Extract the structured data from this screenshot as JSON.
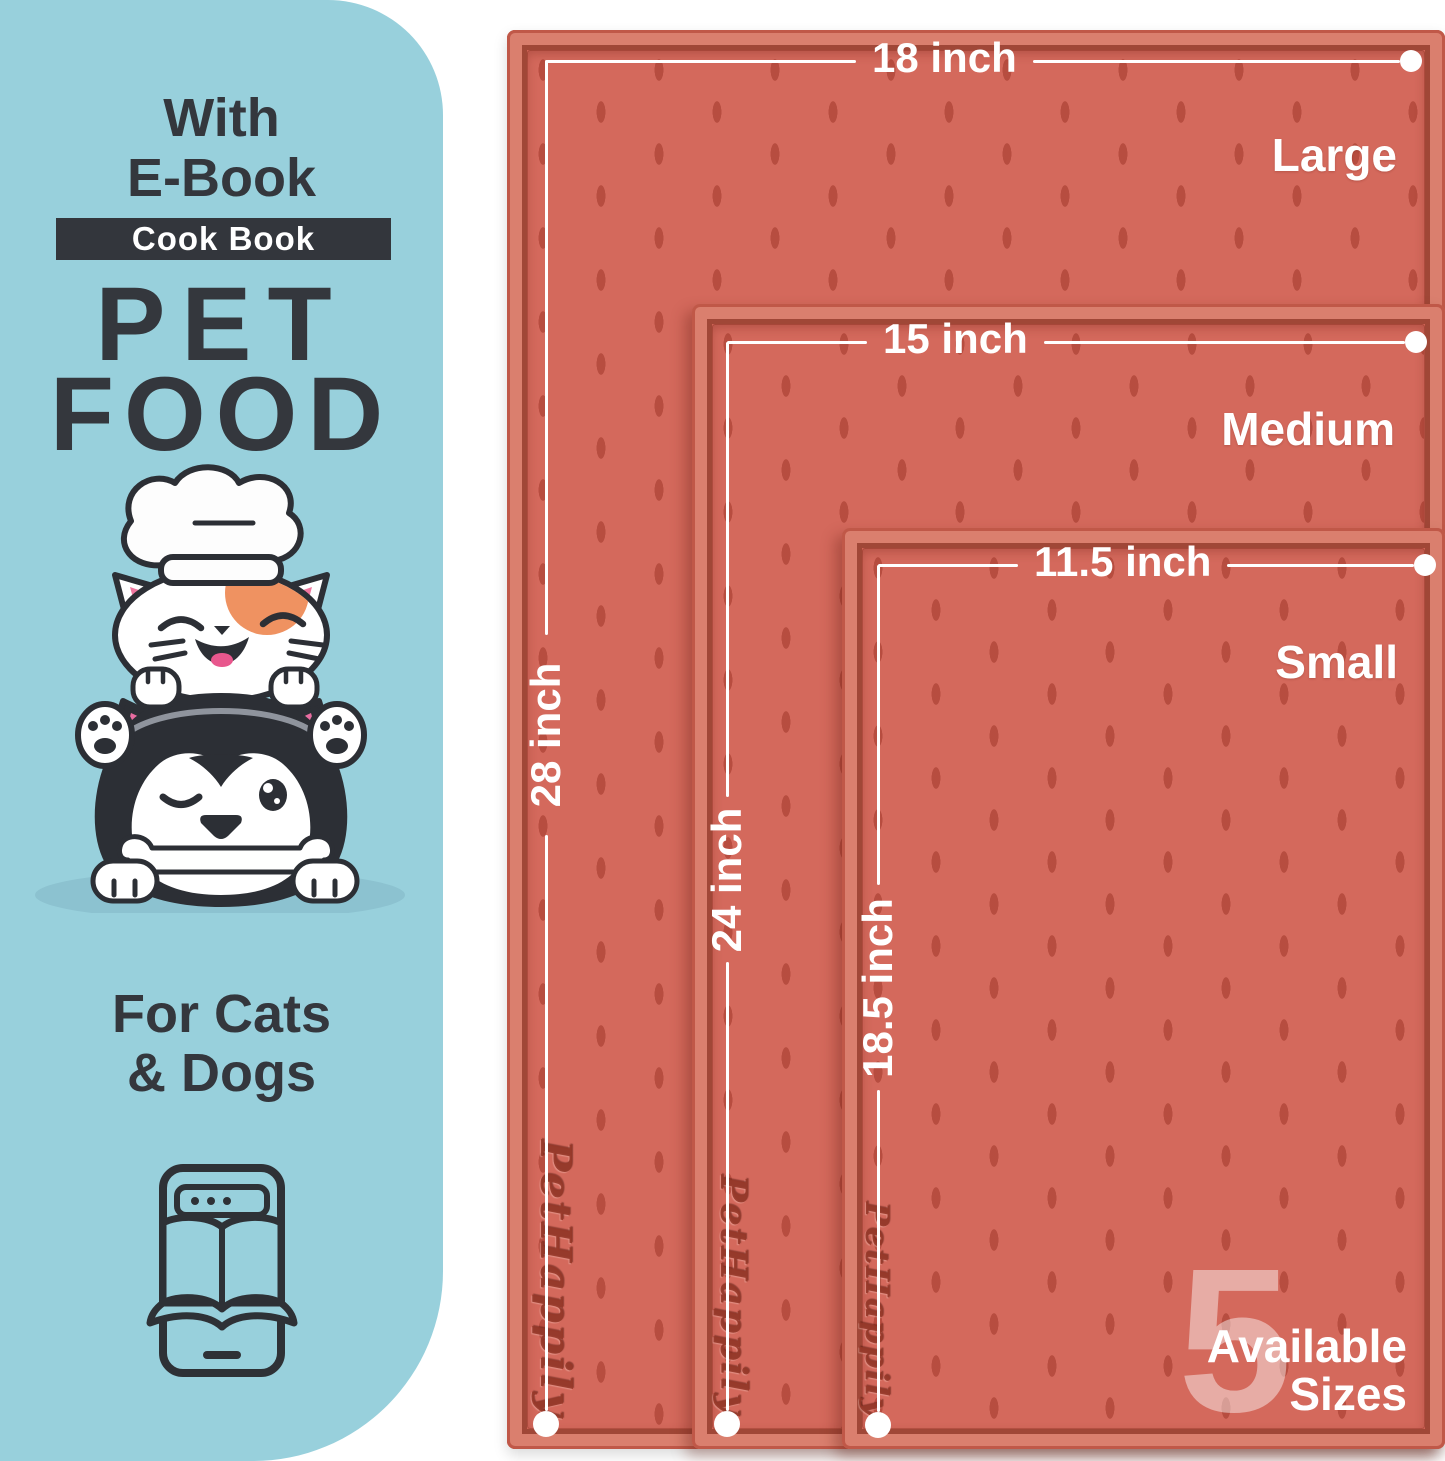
{
  "panel": {
    "intro_line1": "With",
    "intro_line2": "E-Book",
    "badge": "Cook Book",
    "title_line1": "PET",
    "title_line2": "FOOD",
    "audience_line1": "For Cats",
    "audience_line2": "& Dogs"
  },
  "mats": [
    {
      "name": "Large",
      "width_label": "18 inch",
      "height_label": "28 inch"
    },
    {
      "name": "Medium",
      "width_label": "15 inch",
      "height_label": "24 inch"
    },
    {
      "name": "Small",
      "width_label": "11.5 inch",
      "height_label": "18.5 inch"
    }
  ],
  "embossed_brand": "PetHappily",
  "availability": {
    "count": "5",
    "line1": "Available",
    "line2": "Sizes"
  },
  "colors": {
    "panel_blue": "#98d0dc",
    "ink": "#34373d",
    "mat_surface": "#d4695c",
    "mat_rim_light": "#da7f6e",
    "mat_groove": "#a04737",
    "annotation_white": "#ffffff"
  }
}
